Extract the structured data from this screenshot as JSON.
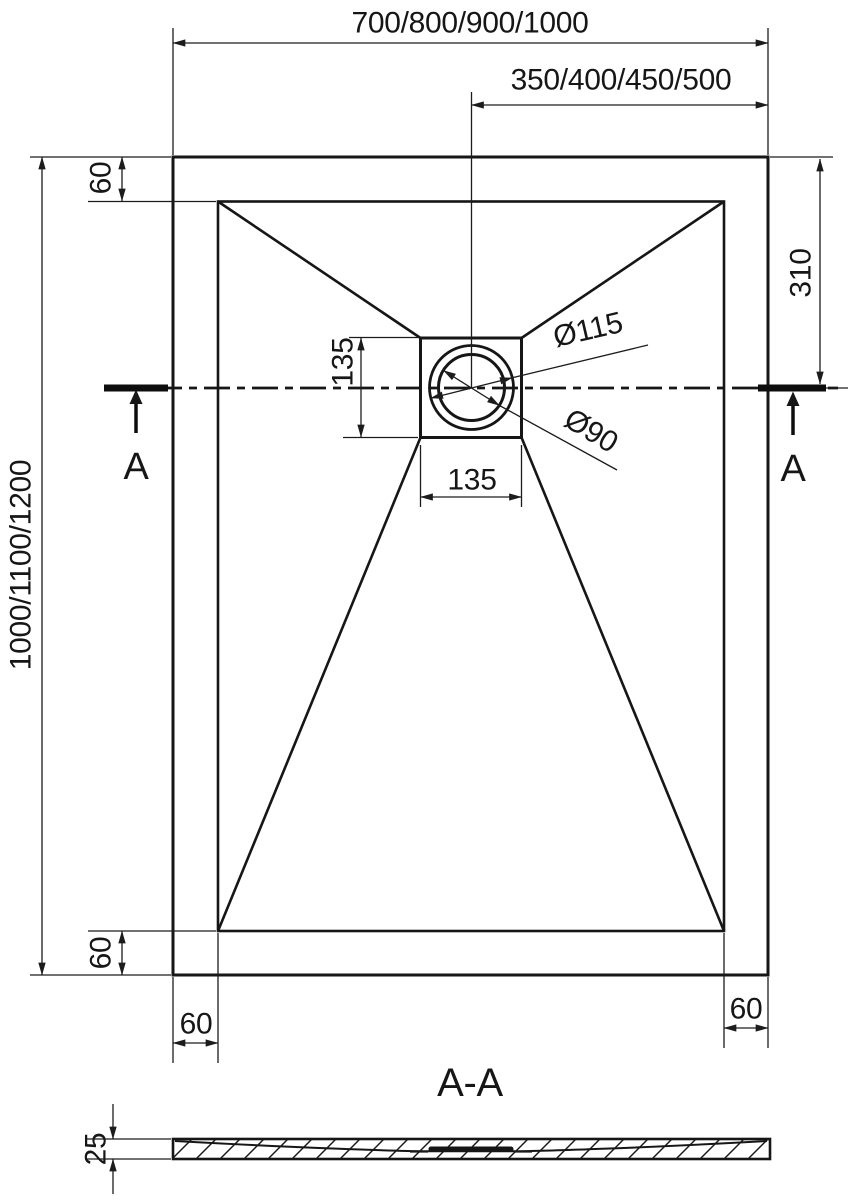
{
  "top_view": {
    "dim_overall_width": "700/800/900/1000",
    "dim_drain_center_offset": "350/400/450/500",
    "dim_overall_length": "1000/1100/1200",
    "dim_rim_top": "60",
    "dim_rim_bottom": "60",
    "dim_rim_left": "60",
    "dim_rim_right": "60",
    "dim_drain_to_top_edge": "310",
    "dim_drain_box_height": "135",
    "dim_drain_box_width": "135",
    "dim_drain_outer_dia": "Ø115",
    "dim_drain_inner_dia": "Ø90",
    "section_marker_left": "A",
    "section_marker_right": "A"
  },
  "section_view": {
    "title": "A-A",
    "dim_thickness": "25"
  },
  "colors": {
    "line": "#1c1c1c",
    "background": "#ffffff"
  }
}
